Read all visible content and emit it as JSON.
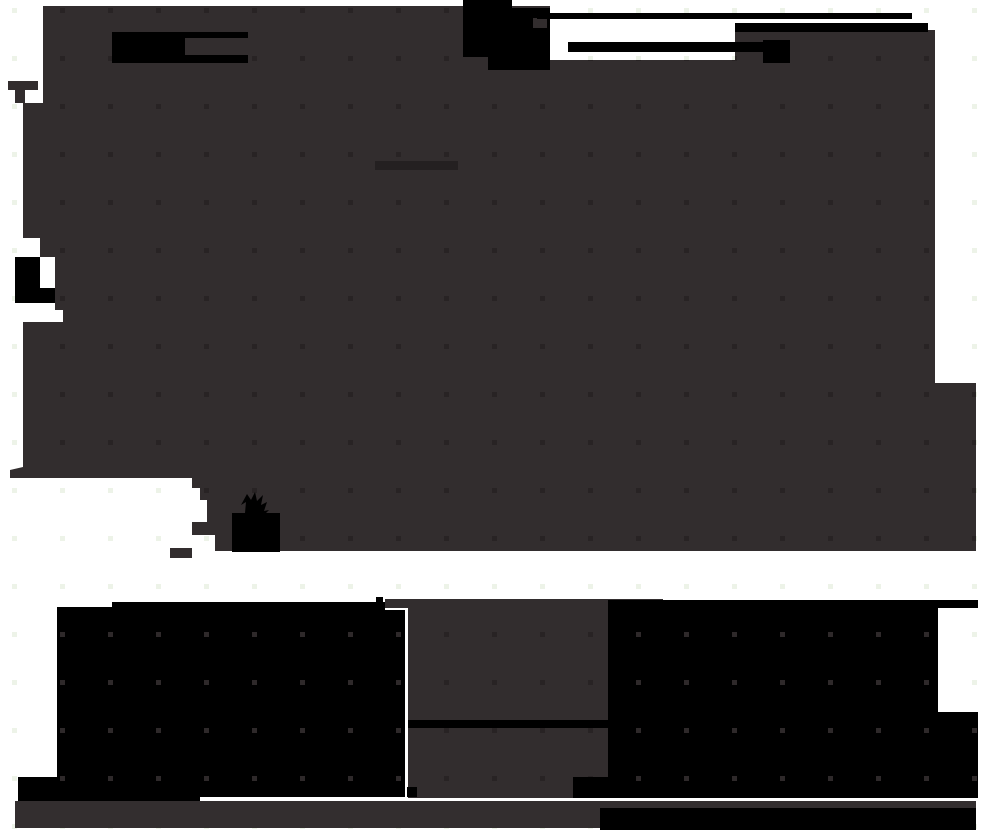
{
  "canvas": {
    "width": 982,
    "height": 836,
    "background": "#ffffff"
  },
  "palette": {
    "white": "#ffffff",
    "ink_black": "#000000",
    "blob_gray": "#322d2e",
    "band_gray": "#332e2f",
    "mark_dark": "#242021",
    "dot_light": "#edf3e8",
    "dot_dark": "#282324",
    "dot_on_black": "#2e292a"
  },
  "grid": {
    "spacing": 48,
    "dot_size": 5,
    "offset_x": 12,
    "offset_y": 8
  },
  "shapes": [
    {
      "name": "light-dot-overlay",
      "type": "dots",
      "pattern": "dotLight",
      "clip": null
    },
    {
      "name": "main-canvas-blob",
      "type": "path",
      "fill": "blob_gray",
      "d": "M43,6 L550,6 L550,60 L735,60 L735,30 L935,30 L935,383 L976,383 L976,551 L232,551 L215,551 L215,535 L192,535 L192,522 L207,522 L207,500 L200,500 L200,488 L192,488 L192,478 L10,478 L10,470 L23,467 L23,322 L63,322 L63,310 L55,310 L55,257 L40,257 L40,238 L23,238 L23,103 L43,103 Z"
    },
    {
      "name": "blob-arm-wedge",
      "type": "path",
      "fill": "blob_gray",
      "d": "M8,81 L38,81 L38,90 L25,90 L25,103 L15,103 L15,90 L8,90 Z"
    },
    {
      "name": "blob-edge-tongue",
      "type": "rect",
      "fill": "blob_gray",
      "x": 170,
      "y": 548,
      "w": 22,
      "h": 10
    },
    {
      "name": "dark-dot-overlay",
      "type": "dots",
      "pattern": "dotDark",
      "clip": [
        "main-canvas-blob"
      ]
    },
    {
      "name": "interior-dark-mark",
      "type": "rect",
      "fill": "mark_dark",
      "x": 375,
      "y": 161,
      "w": 83,
      "h": 9
    },
    {
      "name": "redaction-flag",
      "type": "path",
      "fill": "ink_black",
      "d": "M112,32 L248,32 L248,63 L112,63 Z"
    },
    {
      "name": "redaction-flag-inset",
      "type": "rect",
      "fill": "blob_gray",
      "x": 185,
      "y": 38,
      "w": 63,
      "h": 17
    },
    {
      "name": "top-center-ink-blob",
      "type": "path",
      "fill": "ink_black",
      "d": "M463,0 L512,0 L512,8 L550,8 L550,70 L488,70 L488,57 L463,57 Z"
    },
    {
      "name": "ink-blob-hole",
      "type": "rect",
      "fill": "blob_gray",
      "x": 533,
      "y": 18,
      "w": 14,
      "h": 10
    },
    {
      "name": "ink-line-top",
      "type": "rect",
      "fill": "ink_black",
      "x": 537,
      "y": 13,
      "w": 375,
      "h": 6
    },
    {
      "name": "ink-line-upper",
      "type": "rect",
      "fill": "ink_black",
      "x": 735,
      "y": 23,
      "w": 193,
      "h": 9
    },
    {
      "name": "ink-line-lower",
      "type": "rect",
      "fill": "ink_black",
      "x": 568,
      "y": 42,
      "w": 222,
      "h": 10
    },
    {
      "name": "ink-nub",
      "type": "rect",
      "fill": "ink_black",
      "x": 763,
      "y": 40,
      "w": 27,
      "h": 23
    },
    {
      "name": "left-edge-ink-blob",
      "type": "path",
      "fill": "ink_black",
      "d": "M15,257 L40,257 L40,288 L55,288 L55,303 L15,303 Z"
    },
    {
      "name": "ink-scribble-star",
      "type": "path",
      "fill": "ink_black",
      "d": "M232,513 L245,513 L246,502 L241,505 L247,494 L251,500 L255,492 L257,501 L263,495 L261,505 L267,502 L264,511 L269,510 L266,513 L280,513 L280,552 L232,552 Z"
    },
    {
      "name": "edge-dash",
      "type": "rect",
      "fill": "ink_black",
      "x": 376,
      "y": 597,
      "w": 7,
      "h": 7
    },
    {
      "name": "bottom-left-block",
      "type": "path",
      "fill": "ink_black",
      "d": "M112,602 L385,602 L385,610 L405,610 L405,797 L200,797 L200,802 L18,802 L18,777 L57,777 L57,607 L112,607 Z"
    },
    {
      "name": "funnel-top-segment",
      "type": "path",
      "fill": "blob_gray",
      "d": "M385,599 L663,599 L663,608 L608,608 L608,720 L408,720 L408,608 L385,608 Z"
    },
    {
      "name": "funnel-bottom-segment",
      "type": "path",
      "fill": "blob_gray",
      "d": "M408,728 L608,728 L608,777 L573,777 L573,798 L408,798 Z"
    },
    {
      "name": "funnel-dot-overlay",
      "type": "dots",
      "pattern": "dotDark",
      "clip": [
        "funnel-top-segment",
        "funnel-bottom-segment"
      ]
    },
    {
      "name": "funnel-gap-line",
      "type": "rect",
      "fill": "ink_black",
      "x": 408,
      "y": 720,
      "w": 200,
      "h": 8
    },
    {
      "name": "funnel-corner-notch",
      "type": "rect",
      "fill": "ink_black",
      "x": 573,
      "y": 777,
      "w": 35,
      "h": 21
    },
    {
      "name": "bottom-right-block",
      "type": "path",
      "fill": "ink_black",
      "d": "M608,600 L978,600 L978,608 L938,608 L938,712 L978,712 L978,798 L608,798 Z"
    },
    {
      "name": "block-dot-overlay",
      "type": "dots",
      "pattern": "dotOnBlack",
      "clip": [
        "bottom-left-block",
        "bottom-right-block"
      ]
    },
    {
      "name": "bottom-band-gray",
      "type": "rect",
      "fill": "band_gray",
      "x": 15,
      "y": 801,
      "w": 961,
      "h": 27
    },
    {
      "name": "bottom-band-black",
      "type": "rect",
      "fill": "ink_black",
      "x": 600,
      "y": 808,
      "w": 376,
      "h": 22
    },
    {
      "name": "ink-squiggle",
      "type": "rect",
      "fill": "ink_black",
      "x": 407,
      "y": 787,
      "w": 10,
      "h": 10
    }
  ]
}
